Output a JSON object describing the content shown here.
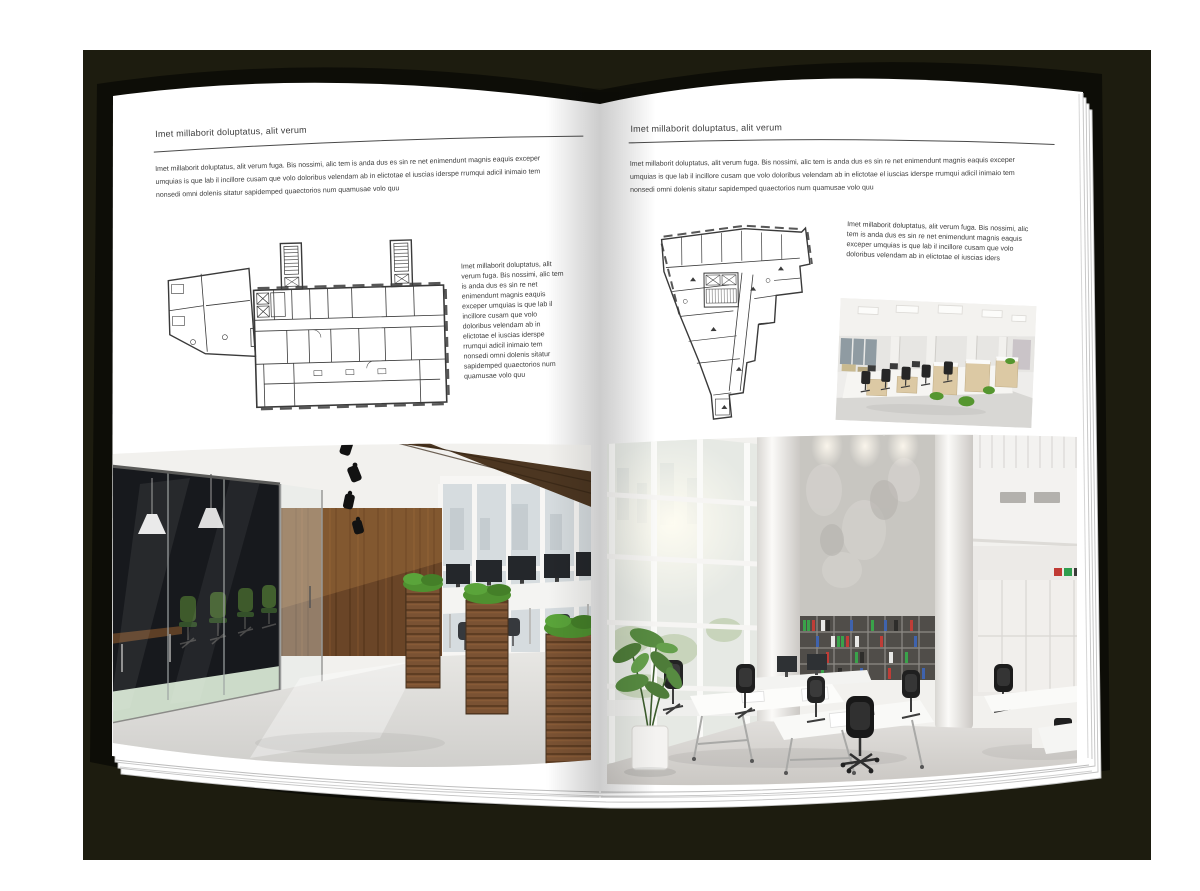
{
  "colors": {
    "backdrop": "#1d1c0f",
    "page": "#ffffff",
    "text": "#3c3c3c",
    "rule": "#4a4a4a",
    "wood_brown": "#6a4527",
    "plant_green": "#4f9130",
    "meeting_chair_green": "#3e5a2b",
    "binder_green": "#3aa24a",
    "binder_red": "#bf3d37",
    "binder_blue": "#3f63ae"
  },
  "left_page": {
    "header": "Imet millaborit doluptatus, alit verum",
    "intro": "Imet millaborit doluptatus, alit verum fuga. Bis nossimi, alic tem is anda dus es sin re net enimendunt magnis eaquis exceper umquias is que lab il incillore cusam que volo doloribus velendam ab in elictotae el iuscias iderspe rrumqui adicil inimaio tem nonsedi omni dolenis sitatur sapidemped quaectorios num quamusae volo quu",
    "side_text": "Imet millaborit doluptatus, alit verum fuga. Bis nossimi, alic tem is anda dus es sin re net enimendunt magnis eaquis exceper umquias is que lab il incillore cusam que volo doloribus velendam ab in elictotae el iuscias iderspe rrumqui adicil inimaio tem nonsedi omni dolenis sitatur sapidemped quaectorios num quamusae volo quu"
  },
  "right_page": {
    "header": "Imet millaborit doluptatus, alit verum",
    "intro": "Imet millaborit doluptatus, alit verum fuga. Bis nossimi, alic tem is anda dus es sin re net enimendunt magnis eaquis exceper umquias is que lab il incillore cusam que volo doloribus velendam ab in elictotae el iuscias iderspe rrumqui adicil inimaio tem nonsedi omni dolenis sitatur sapidemped quaectorios num quamusae volo quu",
    "annotation": "Imet millaborit doluptatus, alit verum fuga. Bis nossimi, alic tem is anda dus es sin re net enimendunt magnis eaquis exceper umquias is que lab il incillore cusam que volo doloribus velendam ab in elictotae el iuscias iders"
  }
}
